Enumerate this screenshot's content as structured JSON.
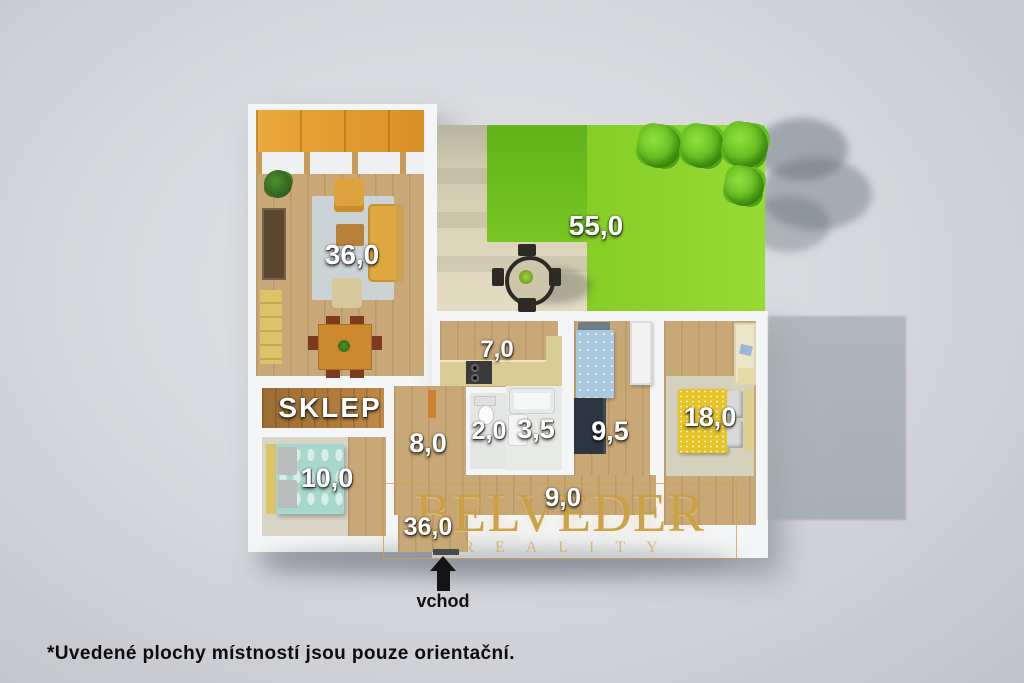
{
  "plan": {
    "rooms": {
      "living_room": {
        "area": "36,0"
      },
      "garden": {
        "area": "55,0"
      },
      "kitchen": {
        "area": "7,0"
      },
      "cellar": {
        "name": "SKLEP"
      },
      "bedroom_left": {
        "area": "10,0"
      },
      "hall_small": {
        "area": "8,0"
      },
      "wc": {
        "area": "2,0"
      },
      "bathroom": {
        "area": "3,5"
      },
      "bedroom_middle": {
        "area": "9,5"
      },
      "bedroom_right": {
        "area": "18,0"
      },
      "hallway": {
        "area": "9,0"
      },
      "entry": {
        "area": "36,0"
      }
    },
    "entrance_label": "vchod"
  },
  "watermark": {
    "brand": "BELVEDER",
    "tagline": "REALITY"
  },
  "footnote": "*Uvedené plochy místností jsou pouze orientační.",
  "colors": {
    "background": "#d6d8dd",
    "wall": "#f4f5f6",
    "wood_floor": "#c9a877",
    "cellar_wood": "#a9793f",
    "grass": "#8ed32c",
    "grass_shadow": "#63b51c",
    "patio": "#d8d1b6",
    "watermark_gold": "#c9a041",
    "label_text": "#ffffff",
    "footnote_text": "#0c0c0c"
  }
}
